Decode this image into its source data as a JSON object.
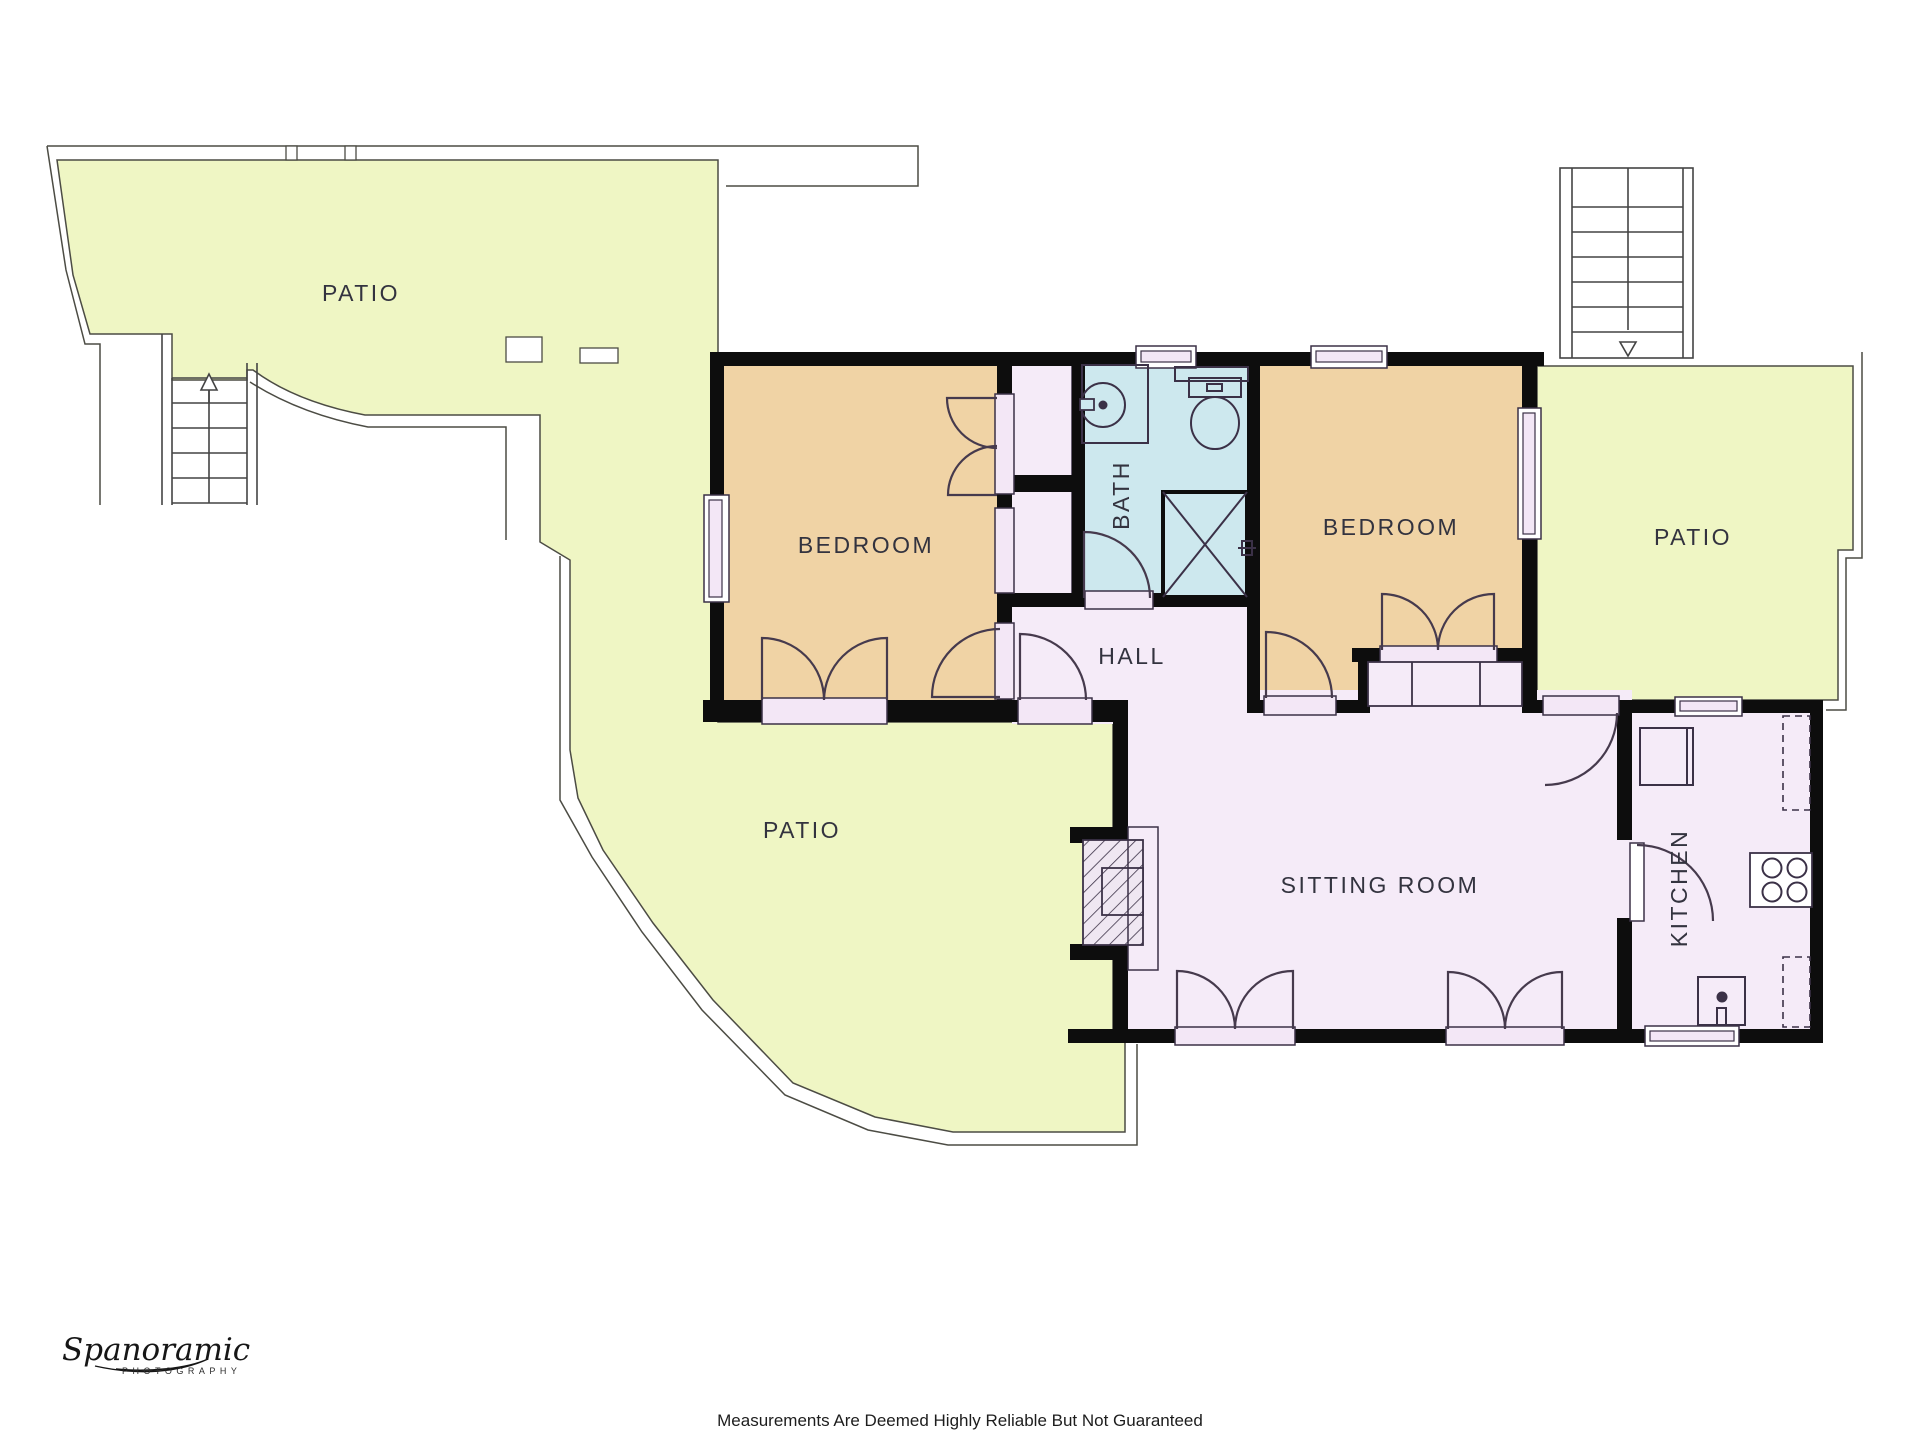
{
  "rooms": {
    "patio_top": {
      "label": "PATIO"
    },
    "patio_left": {
      "label": "PATIO"
    },
    "patio_right": {
      "label": "PATIO"
    },
    "bedroom_left": {
      "label": "BEDROOM"
    },
    "bedroom_right": {
      "label": "BEDROOM"
    },
    "bath": {
      "label": "BATH"
    },
    "hall": {
      "label": "HALL"
    },
    "sitting": {
      "label": "SITTING ROOM"
    },
    "kitchen": {
      "label": "KITCHEN"
    }
  },
  "colors": {
    "patio": "#eff6c4",
    "bedroom": "#f0d3a5",
    "bath": "#cde8ee",
    "floor": "#f5ebf8",
    "sill": "#f3e7f6",
    "wall": "#0d0d0d",
    "white": "#ffffff"
  },
  "footer": {
    "disclaimer": "Measurements Are Deemed Highly Reliable But Not Guaranteed"
  },
  "logo": {
    "name": "Spanoramic",
    "subtitle": "PHOTOGRAPHY"
  }
}
